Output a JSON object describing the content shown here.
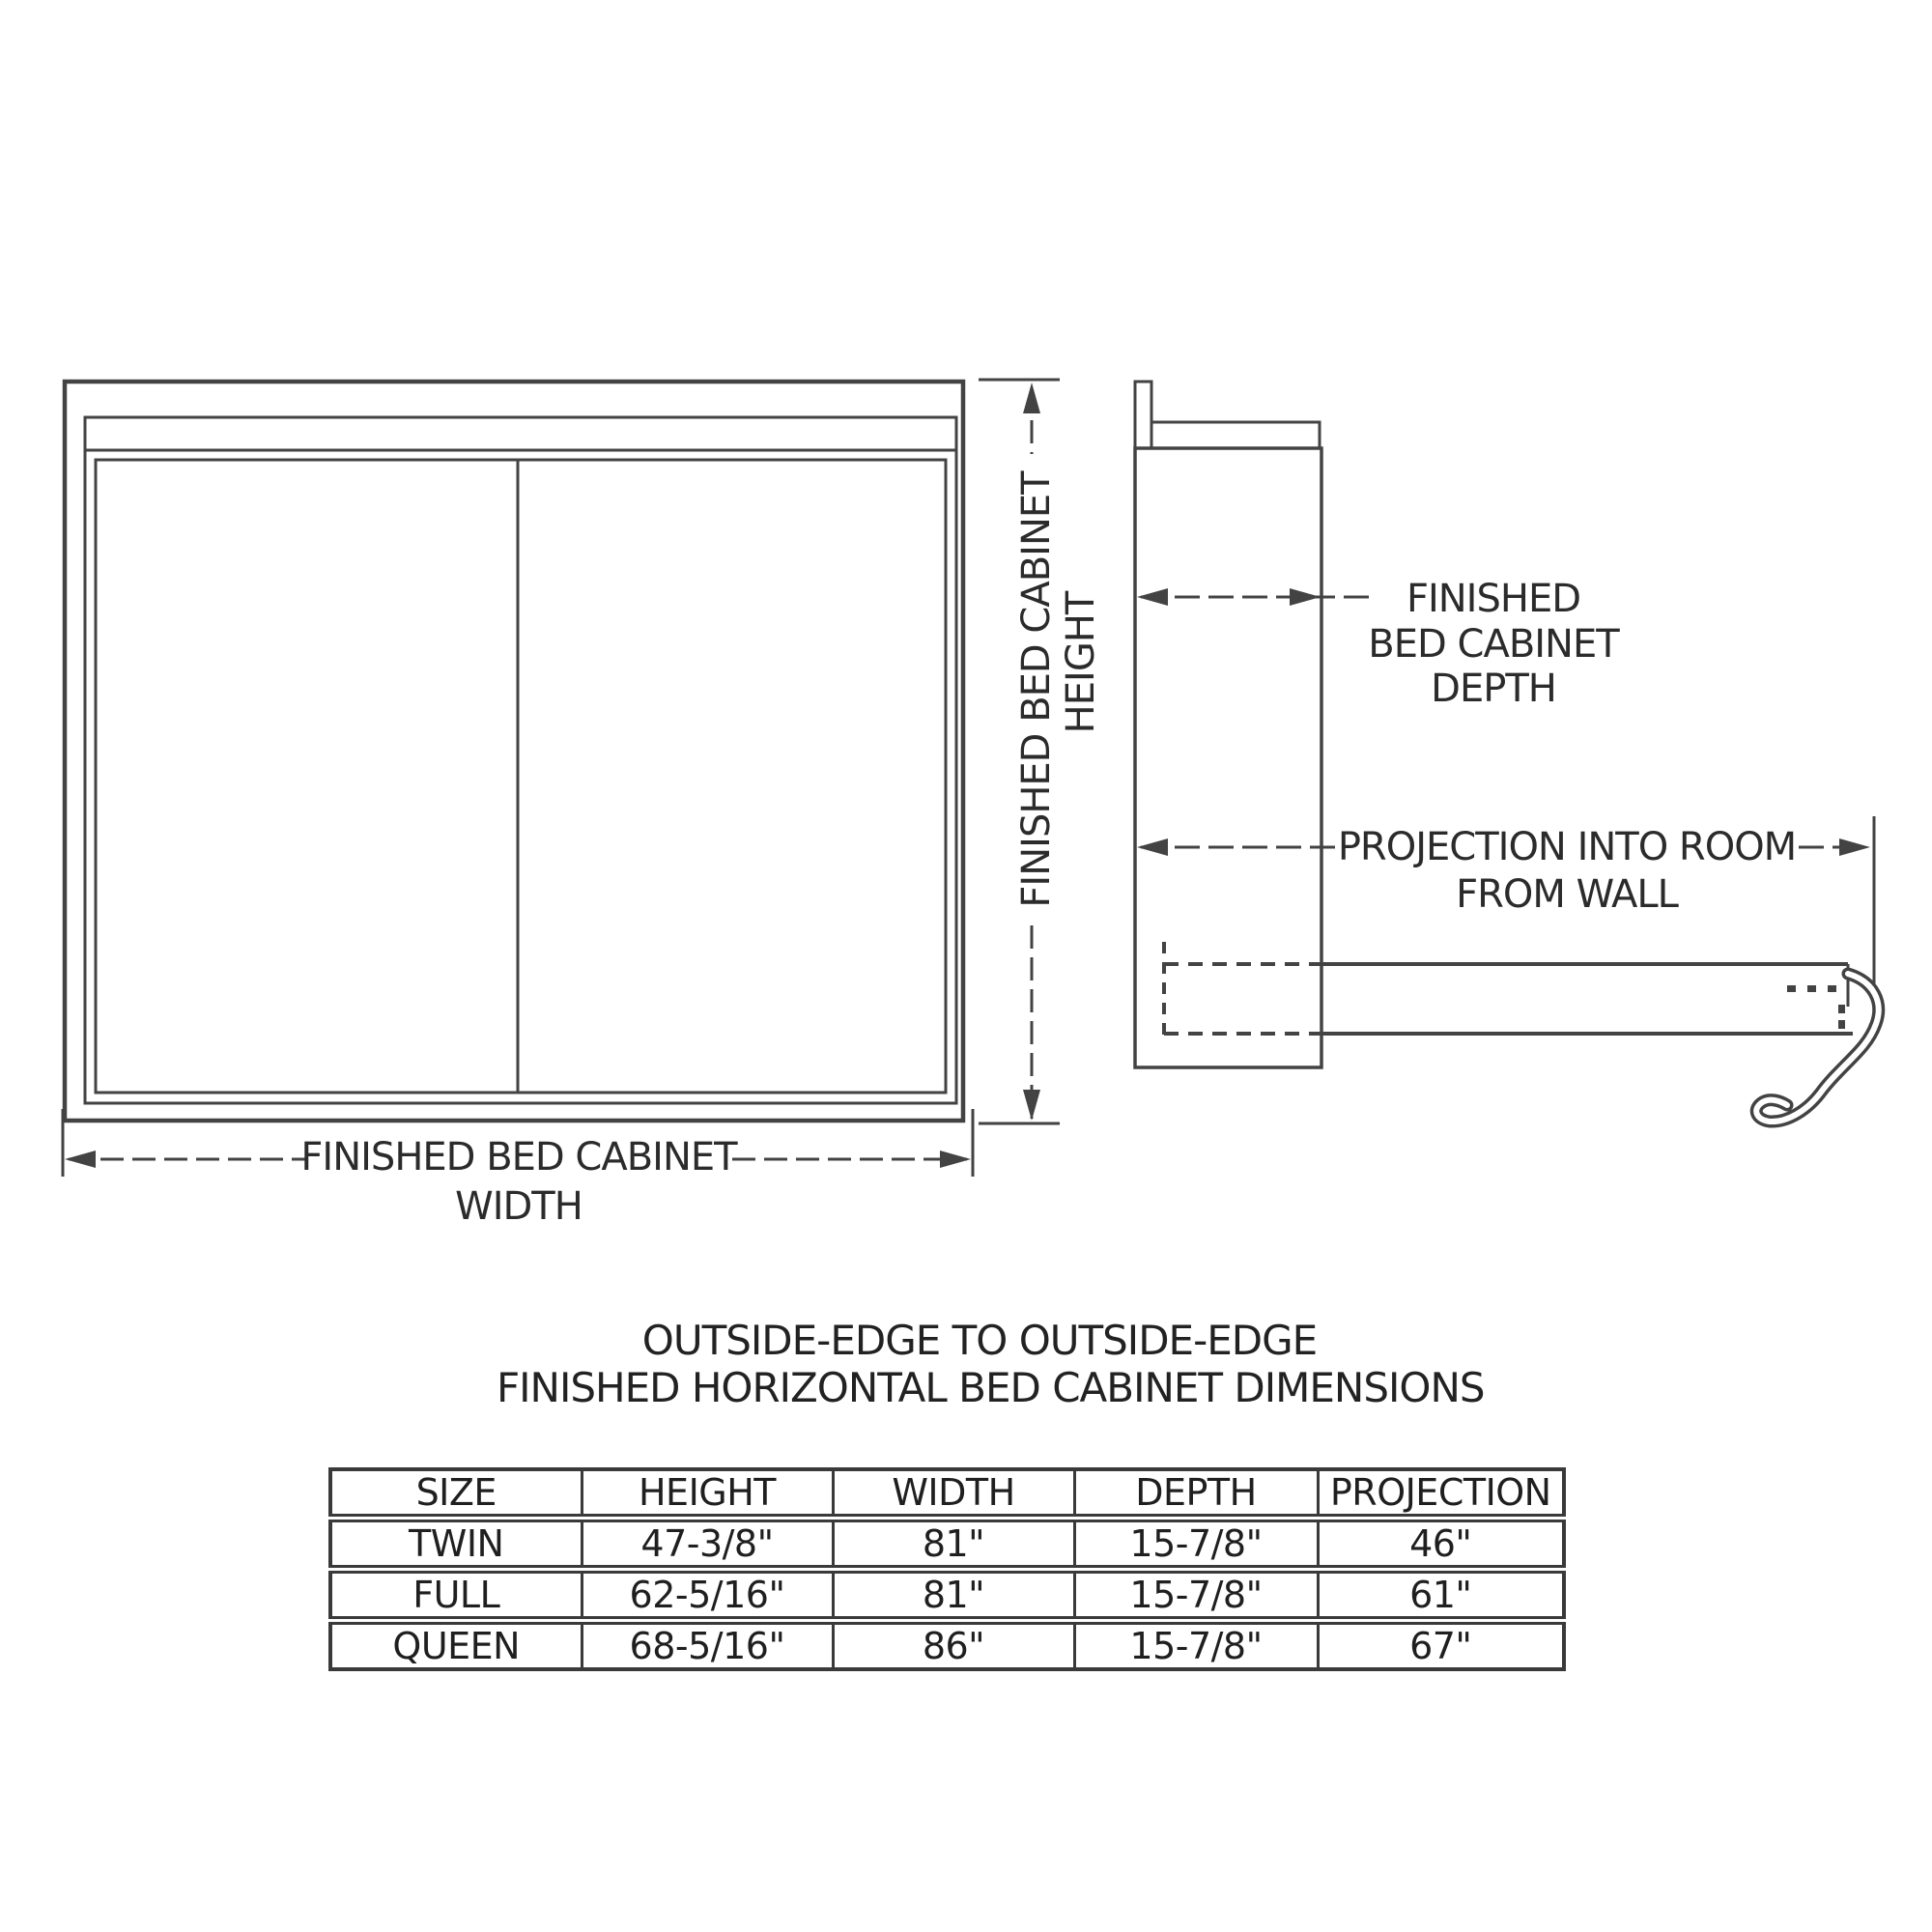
{
  "colors": {
    "paper": "#ffffff",
    "ink": "#434343",
    "text": "#2b2b2b"
  },
  "front_view": {
    "height_label_line1": "FINISHED BED CABINET",
    "height_label_line2": "HEIGHT",
    "width_label_line1": "FINISHED BED CABINET",
    "width_label_line2": "WIDTH"
  },
  "side_view": {
    "depth_label_line1": "FINISHED",
    "depth_label_line2": "BED CABINET",
    "depth_label_line3": "DEPTH",
    "projection_label_line1": "PROJECTION INTO ROOM",
    "projection_label_line2": "FROM WALL"
  },
  "table_title": {
    "line1": "OUTSIDE-EDGE TO OUTSIDE-EDGE",
    "line2": "FINISHED HORIZONTAL BED CABINET DIMENSIONS"
  },
  "dimensions_table": {
    "headers": [
      "SIZE",
      "HEIGHT",
      "WIDTH",
      "DEPTH",
      "PROJECTION"
    ],
    "rows": [
      {
        "size": "TWIN",
        "height": "47-3/8\"",
        "width": "81\"",
        "depth": "15-7/8\"",
        "projection": "46\""
      },
      {
        "size": "FULL",
        "height": "62-5/16\"",
        "width": "81\"",
        "depth": "15-7/8\"",
        "projection": "61\""
      },
      {
        "size": "QUEEN",
        "height": "68-5/16\"",
        "width": "86\"",
        "depth": "15-7/8\"",
        "projection": "67\""
      }
    ]
  }
}
